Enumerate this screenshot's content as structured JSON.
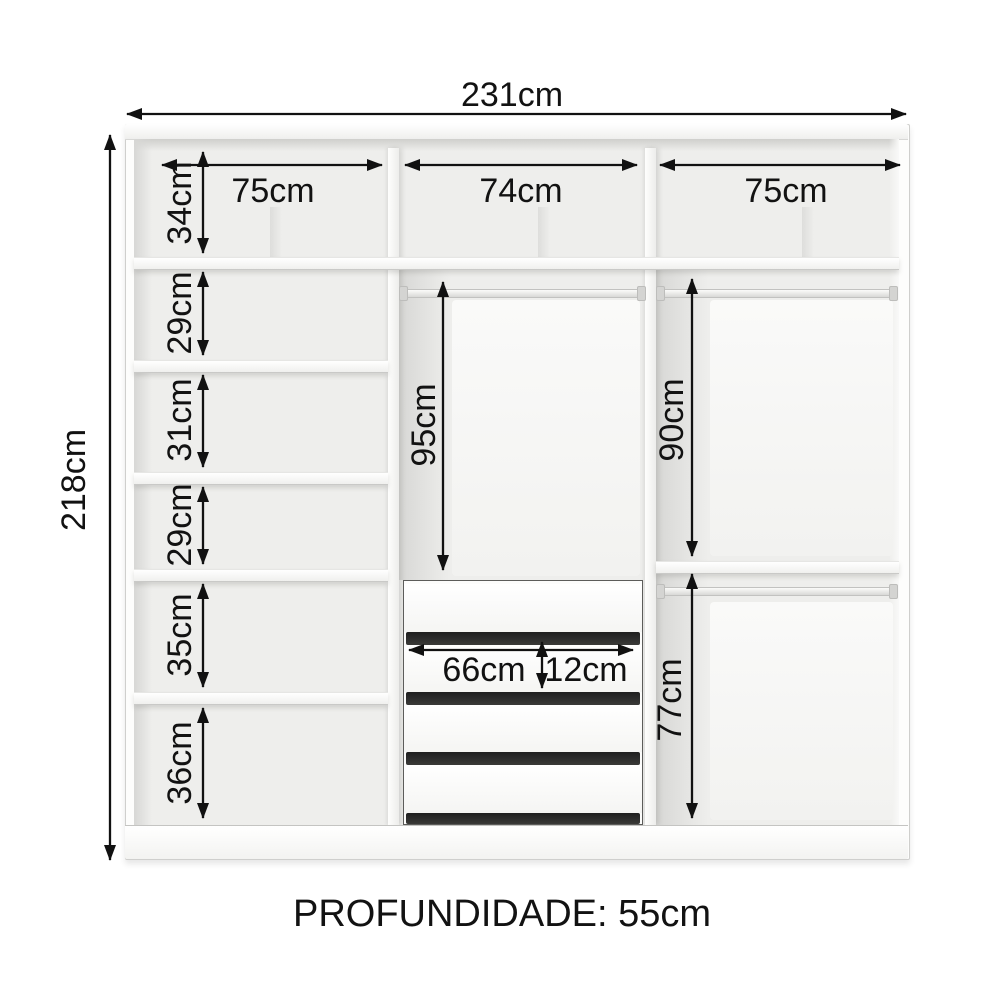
{
  "labels": {
    "total_width": "231cm",
    "total_height": "218cm",
    "depth": "PROFUNDIDADE: 55cm",
    "top_sections": [
      "75cm",
      "74cm",
      "75cm"
    ],
    "left_shelves": [
      "34cm",
      "29cm",
      "31cm",
      "29cm",
      "35cm",
      "36cm"
    ],
    "middle_hanging": "95cm",
    "right_hanging_top": "90cm",
    "right_hanging_bottom": "77cm",
    "drawer_width": "66cm",
    "drawer_height": "12cm"
  },
  "structure": {
    "columns": 3,
    "drawer_count": 4,
    "hanging_rods": 3,
    "left_compartments": 6
  },
  "colors": {
    "background": "#ffffff",
    "interior": "#eeeeec",
    "panel": "#fbfbfa",
    "drawer_gap": "#2d2d2d",
    "dimension": "#111111"
  }
}
